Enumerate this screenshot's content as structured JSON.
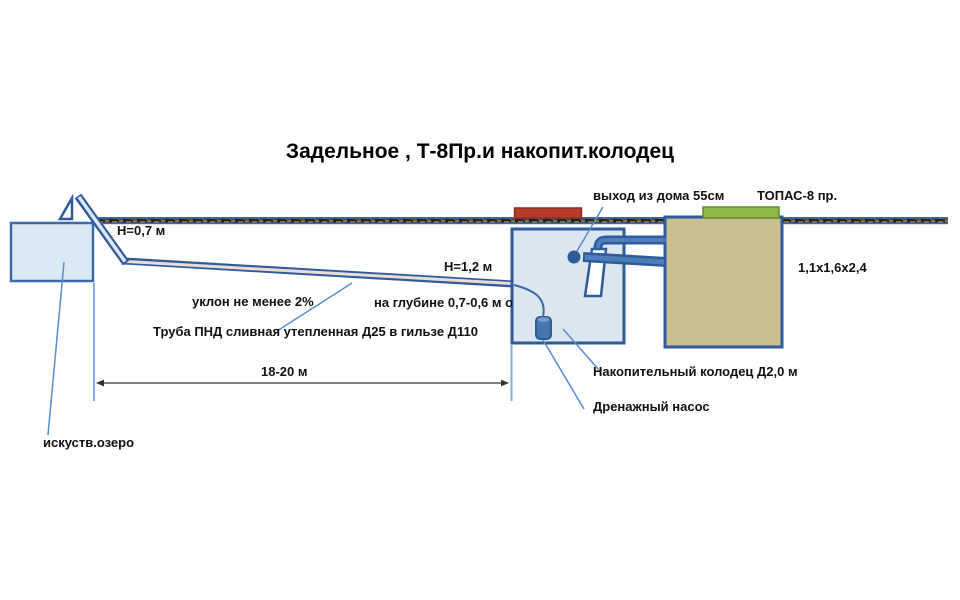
{
  "title": "Задельное , Т-8Пр.и накопит.колодец",
  "labels": {
    "house_exit": "выход из дома 55см",
    "topas_name": "ТОПАС-8 пр.",
    "depth_left": "H=0,7 м",
    "depth_right": "H=1,2 м",
    "slope": "уклон не менее 2%",
    "burial_depth": "на глубине 0,7-0,6 м от по",
    "pipe_spec": "Труба ПНД сливная утепленная Д25 в гильзе Д110",
    "topas_size": "1,1x1,6x2,4",
    "distance": "18-20 м",
    "storage_well": "Накопительный колодец Д2,0 м",
    "drain_pump": "Дренажный насос",
    "lake": "искуств.озеро"
  },
  "colors": {
    "pipe_blue": "#2e5b9a",
    "pipe_core": "#4f7cba",
    "ground_blue": "#3a6ba8",
    "lake_fill": "#d9eaf5",
    "well_fill": "#dce6f1",
    "topas_fill": "#cabe93",
    "lid_red": "#b73a2e",
    "lid_green": "#8fb848",
    "leader_blue": "#5b8bd0",
    "text": "#111111"
  }
}
